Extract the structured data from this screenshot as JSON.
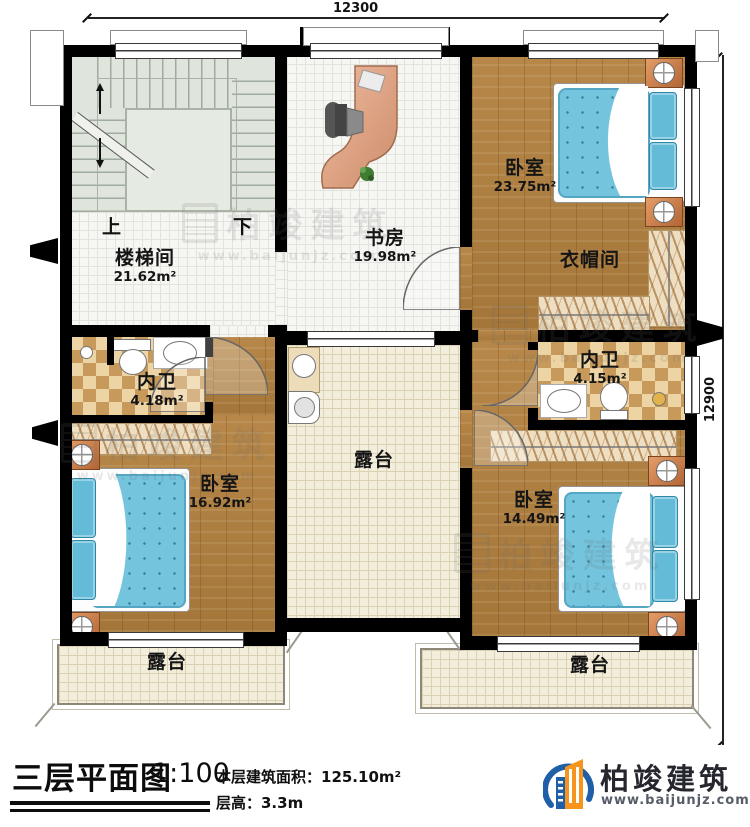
{
  "plan": {
    "dimensions": {
      "top": "12300",
      "right": "12900"
    },
    "rooms": {
      "stairwell": {
        "name": "楼梯间",
        "area": "21.62m²",
        "up": "上",
        "down": "下"
      },
      "study": {
        "name": "书房",
        "area": "19.98m²"
      },
      "bedroom_top_right": {
        "name": "卧室",
        "area": "23.75m²"
      },
      "cloakroom": {
        "name": "衣帽间"
      },
      "bathroom_left": {
        "name": "内卫",
        "area": "4.18m²"
      },
      "bathroom_right": {
        "name": "内卫",
        "area": "4.15m²"
      },
      "bedroom_bottom_left": {
        "name": "卧室",
        "area": "16.92m²"
      },
      "bedroom_bottom_right": {
        "name": "卧室",
        "area": "14.49m²"
      },
      "terrace_center": {
        "name": "露台"
      },
      "terrace_bottom_left": {
        "name": "露台"
      },
      "terrace_bottom_right": {
        "name": "露台"
      }
    }
  },
  "titleblock": {
    "title": "三层平面图",
    "scale": "1:100",
    "area": "本层建筑面积：125.10m²",
    "floor_height": "层高：3.3m"
  },
  "brand": {
    "name": "柏竣建筑",
    "website": "www.baijunjz.com"
  },
  "colors": {
    "wall": "#000000",
    "wood_floor": "#b2803e",
    "mattress_blue": "#74c4de",
    "stair_floor": "#dfe5dc",
    "terrace_floor": "#f3eedb",
    "checker_dark": "#c79a5c",
    "checker_light": "#ecd4a4",
    "brand_orange": "#f7941d",
    "brand_blue": "#1f5fa8"
  }
}
